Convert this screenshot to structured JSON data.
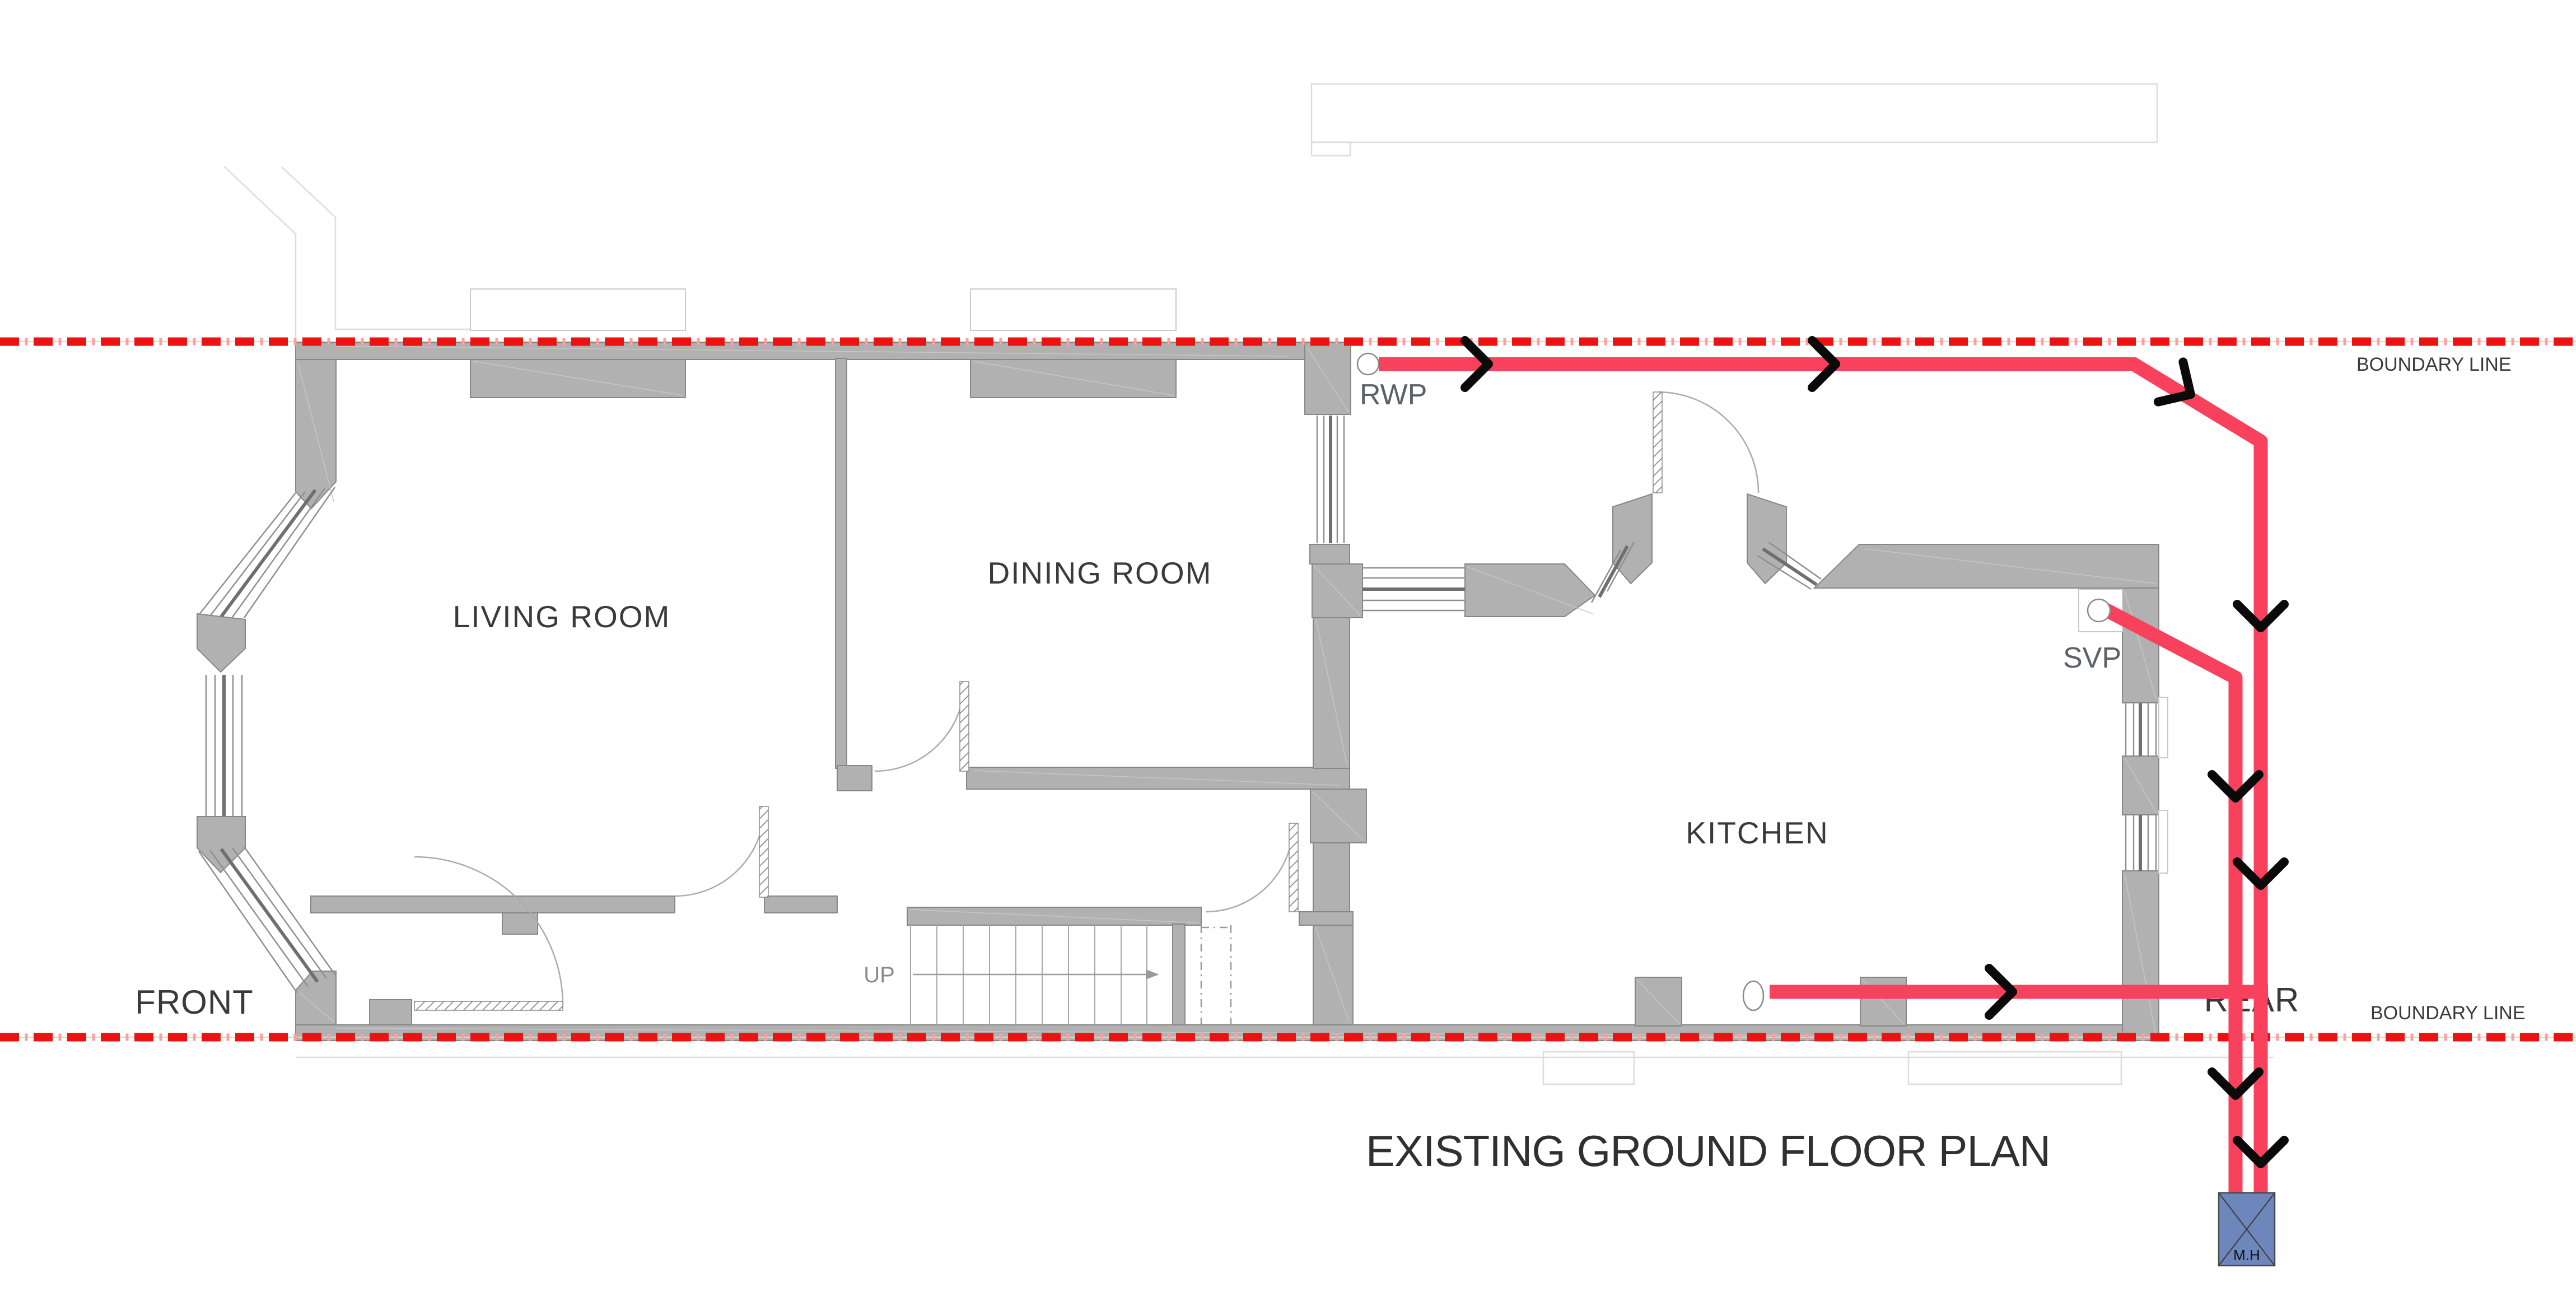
{
  "title": "EXISTING GROUND FLOOR PLAN",
  "boundary": {
    "top_label": "BOUNDARY LINE",
    "bottom_label": "BOUNDARY LINE",
    "line_color": "#ee1111"
  },
  "rooms": {
    "living": "LIVING ROOM",
    "dining": "DINING ROOM",
    "kitchen": "KITCHEN"
  },
  "orientation": {
    "front": "FRONT",
    "rear": "REAR"
  },
  "drainage": {
    "rwp_label": "RWP",
    "svp_label": "SVP",
    "manhole_label": "M.H",
    "pipe_color": "#f7415d",
    "manhole_color": "#6d86bb",
    "flow_arrow_color": "#0a0a0a"
  },
  "stairs": {
    "up_label": "UP"
  },
  "colors": {
    "wall": "#b1b1b1",
    "label_dark": "#3a3a3a",
    "annotation_gray": "#5b6167"
  }
}
